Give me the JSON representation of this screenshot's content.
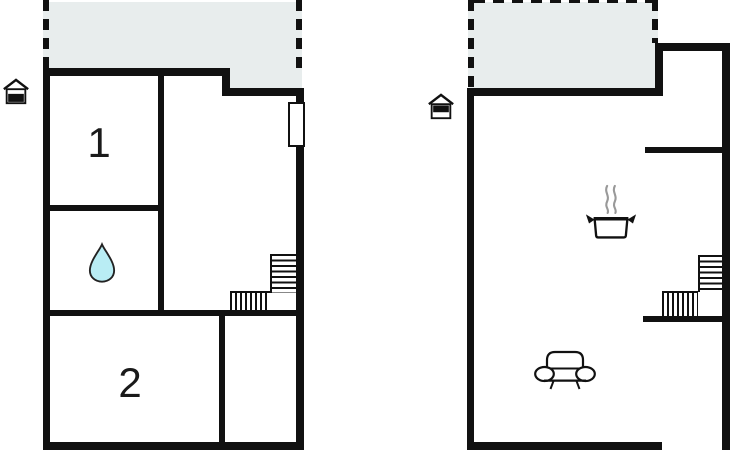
{
  "colors": {
    "wall": "#111111",
    "terrace_fill": "#e8eded",
    "drop_fill": "#b9edf4",
    "steam": "#999999",
    "icon_stroke": "#111111",
    "bg": "#ffffff"
  },
  "left_plan": {
    "name": "ground-floor",
    "rooms": [
      {
        "id": "room-1",
        "label": "1"
      },
      {
        "id": "room-2",
        "label": "2"
      }
    ],
    "icons": [
      {
        "name": "house-ground-floor-icon"
      },
      {
        "name": "water-drop-icon"
      },
      {
        "name": "window"
      },
      {
        "name": "staircase"
      }
    ]
  },
  "right_plan": {
    "name": "upper-floor",
    "icons": [
      {
        "name": "house-upper-floor-icon"
      },
      {
        "name": "cooking-pot-icon"
      },
      {
        "name": "sofa-icon"
      },
      {
        "name": "staircase"
      }
    ]
  }
}
